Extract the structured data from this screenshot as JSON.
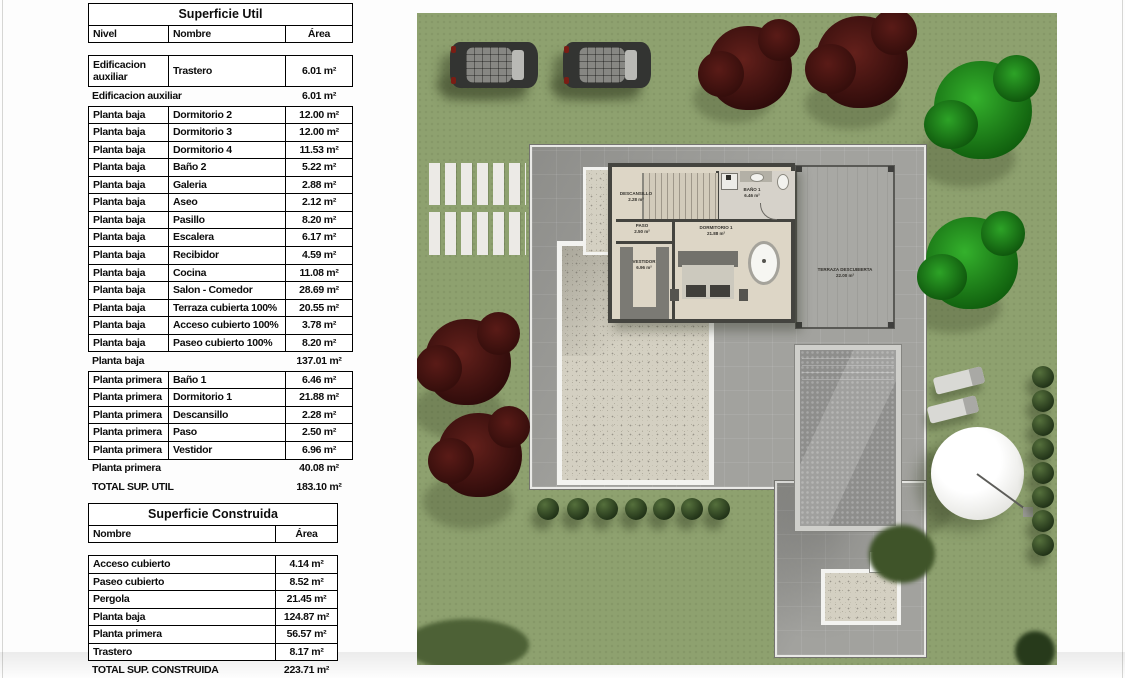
{
  "superficie_util": {
    "title": "Superficie Util",
    "headers": {
      "nivel": "Nivel",
      "nombre": "Nombre",
      "area": "Área"
    },
    "rows": [
      {
        "type": "data",
        "tall": true,
        "nivel": "Edificacion auxiliar",
        "nombre": "Trastero",
        "area": "6.01 m²"
      },
      {
        "type": "subtotal",
        "label": "Edificacion auxiliar",
        "area": "6.01 m²"
      },
      {
        "type": "data",
        "nivel": "Planta baja",
        "nombre": "Dormitorio 2",
        "area": "12.00 m²"
      },
      {
        "type": "data",
        "nivel": "Planta baja",
        "nombre": "Dormitorio 3",
        "area": "12.00 m²"
      },
      {
        "type": "data",
        "nivel": "Planta baja",
        "nombre": "Dormitorio 4",
        "area": "11.53 m²"
      },
      {
        "type": "data",
        "nivel": "Planta baja",
        "nombre": "Baño 2",
        "area": "5.22 m²"
      },
      {
        "type": "data",
        "nivel": "Planta baja",
        "nombre": "Galeria",
        "area": "2.88 m²"
      },
      {
        "type": "data",
        "nivel": "Planta baja",
        "nombre": "Aseo",
        "area": "2.12 m²"
      },
      {
        "type": "data",
        "nivel": "Planta baja",
        "nombre": "Pasillo",
        "area": "8.20 m²"
      },
      {
        "type": "data",
        "nivel": "Planta baja",
        "nombre": "Escalera",
        "area": "6.17 m²"
      },
      {
        "type": "data",
        "nivel": "Planta baja",
        "nombre": "Recibidor",
        "area": "4.59 m²"
      },
      {
        "type": "data",
        "nivel": "Planta baja",
        "nombre": "Cocina",
        "area": "11.08 m²"
      },
      {
        "type": "data",
        "nivel": "Planta baja",
        "nombre": "Salon - Comedor",
        "area": "28.69 m²"
      },
      {
        "type": "data",
        "nivel": "Planta baja",
        "nombre": "Terraza cubierta 100%",
        "area": "20.55 m²"
      },
      {
        "type": "data",
        "nivel": "Planta baja",
        "nombre": "Acceso cubierto 100%",
        "area": "3.78 m²"
      },
      {
        "type": "data",
        "nivel": "Planta baja",
        "nombre": "Paseo cubierto 100%",
        "area": "8.20 m²"
      },
      {
        "type": "subtotal",
        "label": "Planta baja",
        "area": "137.01 m²"
      },
      {
        "type": "data",
        "nivel": "Planta primera",
        "nombre": "Baño 1",
        "area": "6.46 m²"
      },
      {
        "type": "data",
        "nivel": "Planta primera",
        "nombre": "Dormitorio 1",
        "area": "21.88 m²"
      },
      {
        "type": "data",
        "nivel": "Planta primera",
        "nombre": "Descansillo",
        "area": "2.28 m²"
      },
      {
        "type": "data",
        "nivel": "Planta primera",
        "nombre": "Paso",
        "area": "2.50 m²"
      },
      {
        "type": "data",
        "nivel": "Planta primera",
        "nombre": "Vestidor",
        "area": "6.96 m²"
      },
      {
        "type": "subtotal",
        "label": "Planta primera",
        "area": "40.08 m²"
      },
      {
        "type": "total",
        "label": "TOTAL SUP. UTIL",
        "area": "183.10 m²"
      }
    ]
  },
  "superficie_construida": {
    "title": "Superficie Construida",
    "headers": {
      "nombre": "Nombre",
      "area": "Área"
    },
    "rows": [
      {
        "type": "data",
        "nombre": "Acceso cubierto",
        "area": "4.14 m²"
      },
      {
        "type": "data",
        "nombre": "Paseo cubierto",
        "area": "8.52 m²"
      },
      {
        "type": "data",
        "nombre": "Pergola",
        "area": "21.45 m²"
      },
      {
        "type": "data",
        "nombre": "Planta baja",
        "area": "124.87 m²"
      },
      {
        "type": "data",
        "nombre": "Planta primera",
        "area": "56.57 m²"
      },
      {
        "type": "data",
        "nombre": "Trastero",
        "area": "8.17 m²"
      },
      {
        "type": "total",
        "label": "TOTAL SUP. CONSTRUIDA",
        "area": "223.71 m²"
      }
    ]
  },
  "site_plan": {
    "rooms": {
      "descansillo": {
        "name": "DESCANSILLO",
        "area": "2.28 m²"
      },
      "paso": {
        "name": "PASO",
        "area": "2.50 m²"
      },
      "bano1": {
        "name": "BAÑO 1",
        "area": "6.46 m²"
      },
      "dormitorio1": {
        "name": "DORMITORIO 1",
        "area": "21.88 m²"
      },
      "vestidor": {
        "name": "VESTIDOR",
        "area": "6.96 m²"
      },
      "terraza": {
        "name": "TERRAZA DESCUBIERTA",
        "area": "22.00 m²"
      }
    },
    "features": {
      "cars": 2,
      "bushes_row": 7,
      "bushes_column": 8,
      "maroon_trees": 4,
      "green_trees": 2
    },
    "colors": {
      "grass": "#8ea16f",
      "paving": "#9d9d99",
      "gravel": "#d4d0c2",
      "wall": "#44443f",
      "floor": "#ddd6c6",
      "pool": "#8e8e8c",
      "bush": "#2e4420",
      "tree_maroon": "#4a1412",
      "tree_green": "#1d8f1a"
    }
  }
}
